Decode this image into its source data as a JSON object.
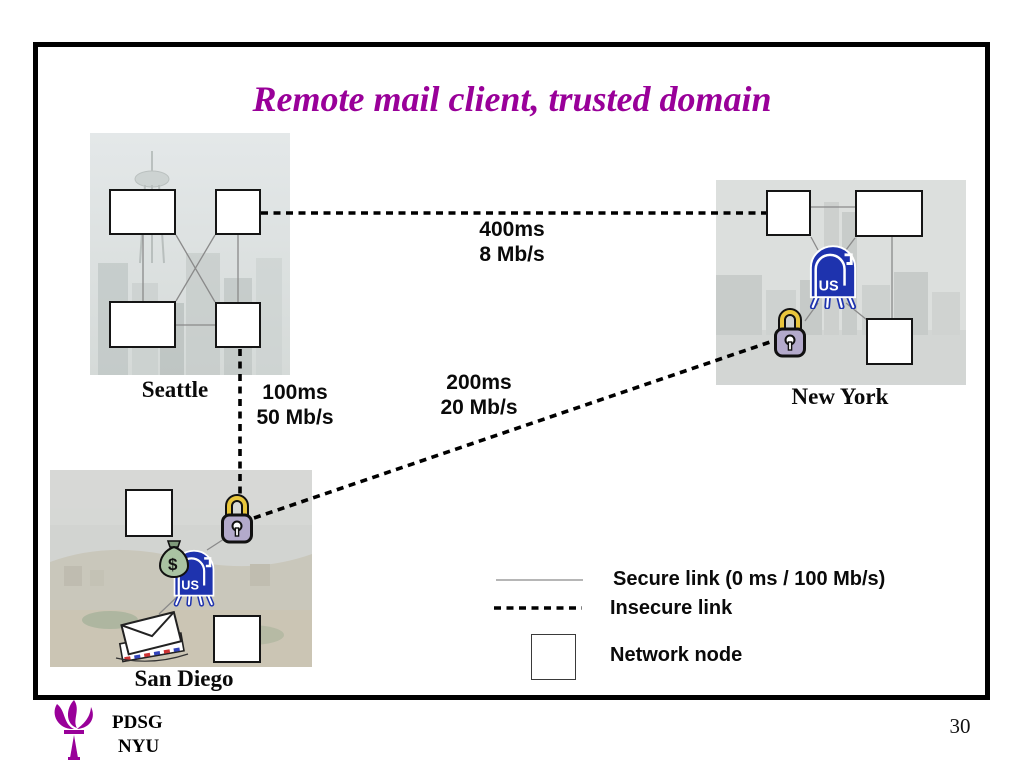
{
  "slide": {
    "title": "Remote mail client, trusted domain",
    "page_number": "30"
  },
  "cities": {
    "seattle": {
      "label": "Seattle"
    },
    "new_york": {
      "label": "New York"
    },
    "san_diego": {
      "label": "San Diego"
    }
  },
  "links": {
    "seattle_new_york": {
      "latency": "400ms",
      "bandwidth": "8 Mb/s"
    },
    "seattle_san_diego": {
      "latency": "100ms",
      "bandwidth": "50 Mb/s"
    },
    "san_diego_new_york": {
      "latency": "200ms",
      "bandwidth": "20 Mb/s"
    }
  },
  "legend": {
    "secure_label": "Secure link (0 ms / 100 Mb/s)",
    "insecure_label": "Insecure link",
    "node_label": "Network node"
  },
  "icons": {
    "mailbox_text": "US",
    "money_bag_text": "$",
    "mailbox": "us-mailbox-icon",
    "padlock": "padlock-icon",
    "money_bag": "money-bag-icon",
    "envelopes": "envelopes-icon",
    "torch": "nyu-torch-icon"
  },
  "footer": {
    "org": "PDSG",
    "school": "NYU"
  },
  "colors": {
    "title_purple": "#990099",
    "mailbox_blue": "#1e33ae",
    "padlock_gold": "#e9c63c",
    "padlock_body": "#b3aacb",
    "money_green": "#a9c3a2",
    "secure_line_gray": "#8a8a8a",
    "insecure_line_black": "#000000"
  }
}
